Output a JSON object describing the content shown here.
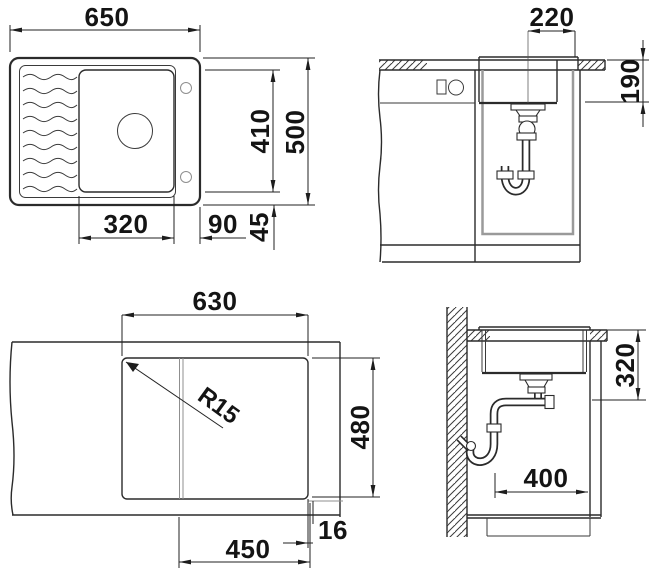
{
  "colors": {
    "line": "#2b2b2b",
    "light_line": "#8f8f8f",
    "text": "#141414",
    "background": "#ffffff"
  },
  "top_view": {
    "overall_width": "650",
    "overall_depth": "500",
    "bowl_length": "410",
    "bowl_width": "320",
    "bowl_right_offset": "90",
    "bowl_edge_gap": "45"
  },
  "front_view": {
    "drain_to_edge": "220",
    "bowl_depth": "190"
  },
  "cutout_view": {
    "cutout_width": "630",
    "cutout_depth": "480",
    "glass_section_width": "450",
    "glass_overhang": "16",
    "corner_radius": "R15"
  },
  "side_view": {
    "depth_below_counter": "320",
    "trap_clearance": "400"
  }
}
